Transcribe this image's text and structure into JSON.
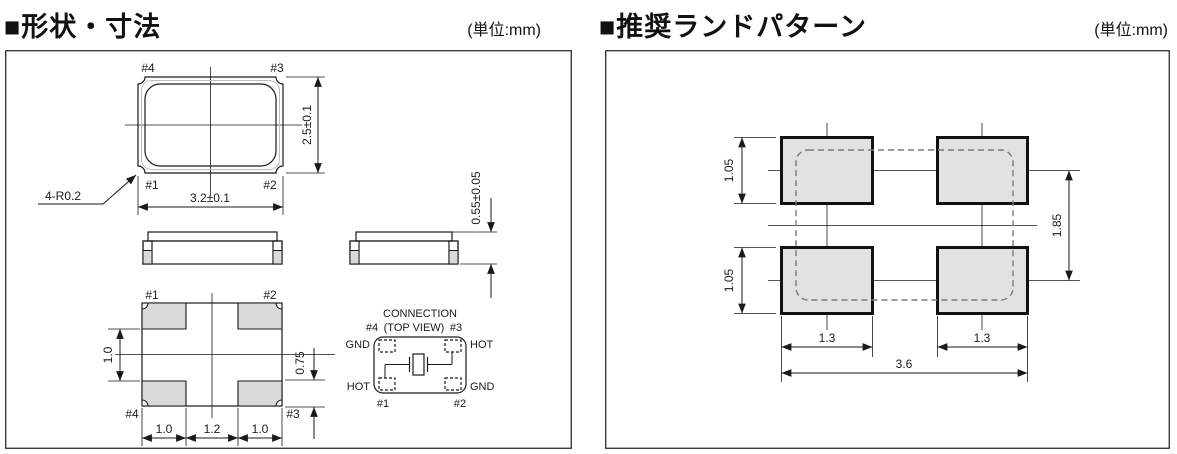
{
  "colors": {
    "line": "#1a1a1a",
    "pad_fill": "#e2e2e2",
    "terminal_fill": "#d9d9d9",
    "dashed_outline": "#7a7a7a"
  },
  "left_panel": {
    "title": "■形状・寸法",
    "unit": "(単位:mm)",
    "top_view": {
      "pin_top_left": "#4",
      "pin_top_right": "#3",
      "pin_bottom_left": "#1",
      "pin_bottom_right": "#2",
      "width_dim": "3.2±0.1",
      "height_dim": "2.5±0.1",
      "corner_radius_note": "4-R0.2"
    },
    "side_view": {
      "thickness_dim": "0.55±0.05"
    },
    "bottom_view": {
      "pin_top_left": "#1",
      "pin_top_right": "#2",
      "pin_bottom_left": "#4",
      "pin_bottom_right": "#3",
      "pad_gap_dim": "1.0",
      "pad_height_dim": "0.75",
      "pad_width_left_dim": "1.0",
      "pad_pitch_dim": "1.2",
      "pad_width_right_dim": "1.0"
    },
    "connection": {
      "heading_line1": "CONNECTION",
      "heading_line2": "(TOP VIEW)",
      "pin_top_left": "#4",
      "pin_top_right": "#3",
      "pin_bottom_left": "#1",
      "pin_bottom_right": "#2",
      "net_top_left": "GND",
      "net_top_right": "HOT",
      "net_bottom_left": "HOT",
      "net_bottom_right": "GND"
    }
  },
  "right_panel": {
    "title": "■推奨ランドパターン",
    "unit": "(単位:mm)",
    "land_pattern": {
      "pad_height_top_dim": "1.05",
      "pad_height_bottom_dim": "1.05",
      "row_pitch_dim": "1.85",
      "pad_width_left_dim": "1.3",
      "pad_width_right_dim": "1.3",
      "overall_width_dim": "3.6"
    }
  }
}
